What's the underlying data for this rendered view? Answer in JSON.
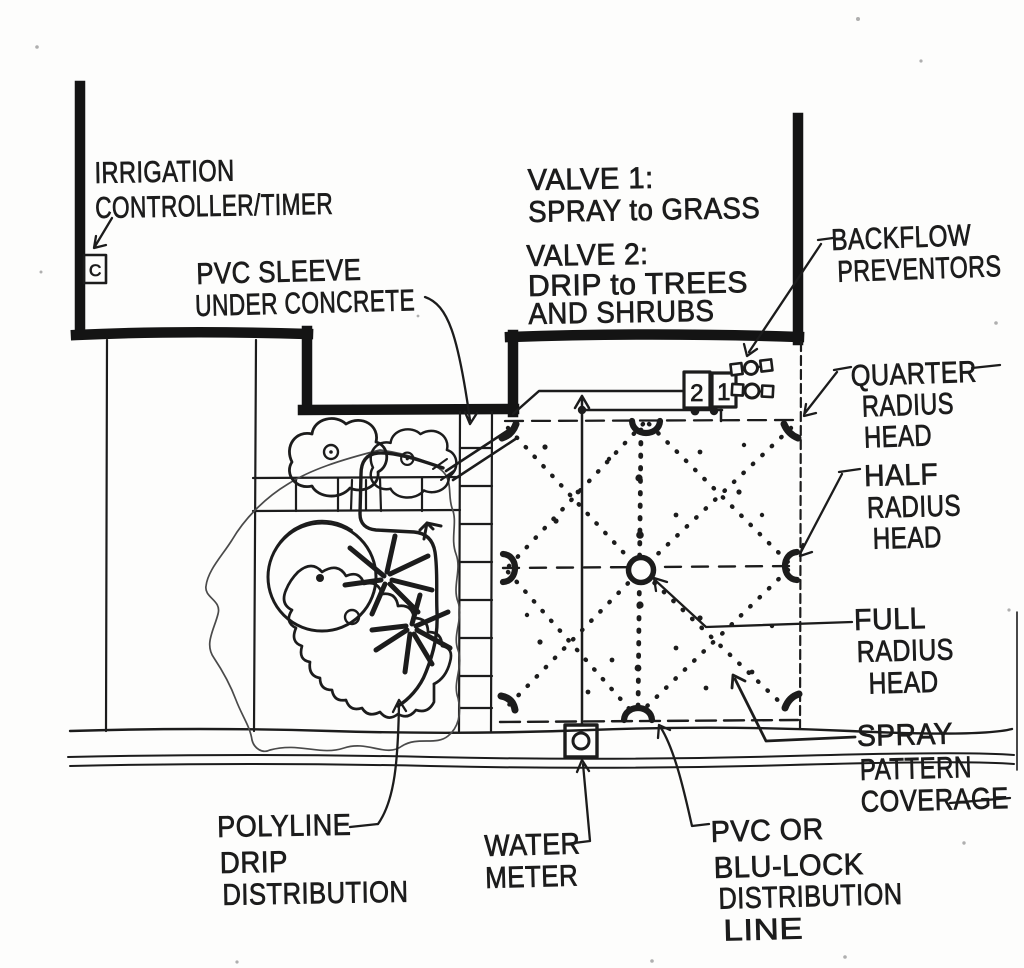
{
  "colors": {
    "ink": "#1c1c1c",
    "paper": "#fdfdfc"
  },
  "labels": {
    "irrigation_controller": {
      "line1": "IRRIGATION",
      "line2": "CONTROLLER/TIMER"
    },
    "pvc_sleeve": {
      "line1": "PVC SLEEVE",
      "line2": "UNDER CONCRETE"
    },
    "valve1": {
      "line1": "VALVE 1:",
      "line2": "SPRAY to GRASS"
    },
    "valve2": {
      "line1": "VALVE 2:",
      "line2": "DRIP to TREES",
      "line3": "AND SHRUBS"
    },
    "backflow": {
      "line1": "BACKFLOW",
      "line2": "PREVENTORS"
    },
    "quarter_radius": {
      "line1": "QUARTER",
      "line2": "RADIUS",
      "line3": "HEAD"
    },
    "half_radius": {
      "line1": "HALF",
      "line2": "RADIUS",
      "line3": "HEAD"
    },
    "full_radius": {
      "line1": "FULL",
      "line2": "RADIUS",
      "line3": "HEAD"
    },
    "spray_pattern": {
      "line1": "SPRAY",
      "line2": "PATTERN",
      "line3": "COVERAGE"
    },
    "polyline_drip": {
      "line1": "POLYLINE",
      "line2": "DRIP",
      "line3": "DISTRIBUTION"
    },
    "water_meter": {
      "line1": "WATER",
      "line2": "METER"
    },
    "pvc_distribution": {
      "line1": "PVC OR",
      "line2": "BLU-LOCK",
      "line3": "DISTRIBUTION",
      "line4": "LINE"
    }
  },
  "symbols": {
    "controller_letter": "C",
    "valve_box_left": "2",
    "valve_box_right": "1"
  }
}
